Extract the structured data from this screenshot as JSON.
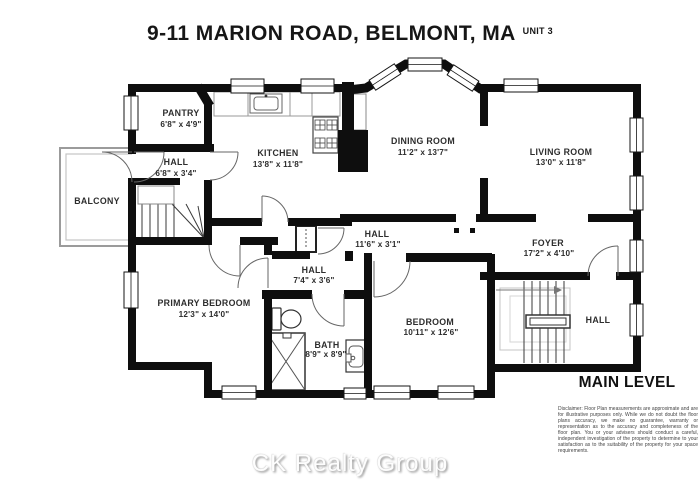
{
  "header": {
    "address": "9-11 MARION ROAD, BELMONT, MA",
    "unit": "UNIT 3"
  },
  "plan": {
    "level": "MAIN LEVEL",
    "rooms": {
      "pantry": {
        "name": "PANTRY",
        "dims": "6'8\" x 4'9\""
      },
      "hall_upper": {
        "name": "HALL",
        "dims": "6'8\" x 3'4\""
      },
      "balcony": {
        "name": "BALCONY",
        "dims": ""
      },
      "kitchen": {
        "name": "KITCHEN",
        "dims": "13'8\" x 11'8\""
      },
      "dining": {
        "name": "DINING ROOM",
        "dims": "11'2\" x 13'7\""
      },
      "living": {
        "name": "LIVING ROOM",
        "dims": "13'0\" x 11'8\""
      },
      "hall_mid": {
        "name": "HALL",
        "dims": "11'6\" x 3'1\""
      },
      "foyer": {
        "name": "FOYER",
        "dims": "17'2\" x 4'10\""
      },
      "hall_small": {
        "name": "HALL",
        "dims": "7'4\" x 3'6\""
      },
      "primary": {
        "name": "PRIMARY BEDROOM",
        "dims": "12'3\" x 14'0\""
      },
      "bath": {
        "name": "BATH",
        "dims": "8'9\" x 8'9\""
      },
      "bedroom": {
        "name": "BEDROOM",
        "dims": "10'11\" x 12'6\""
      },
      "hall_lower": {
        "name": "HALL",
        "dims": ""
      }
    }
  },
  "footer": {
    "watermark": "CK Realty Group",
    "disclaimer": "Disclaimer: Floor Plan measurements are approximate and are for illustrative purposes only. While we do not doubt the floor plans accuracy, we make no guarantee, warranty or representation as to the accuracy and completeness of the floor plan. You or your advisers should conduct a careful, independent investigation of the property to determine to your satisfaction as to the suitability of the property for your space requirements."
  },
  "colors": {
    "wall": "#0e0e0e",
    "text": "#2d2d2d",
    "watermark_shadow": "#969696"
  }
}
